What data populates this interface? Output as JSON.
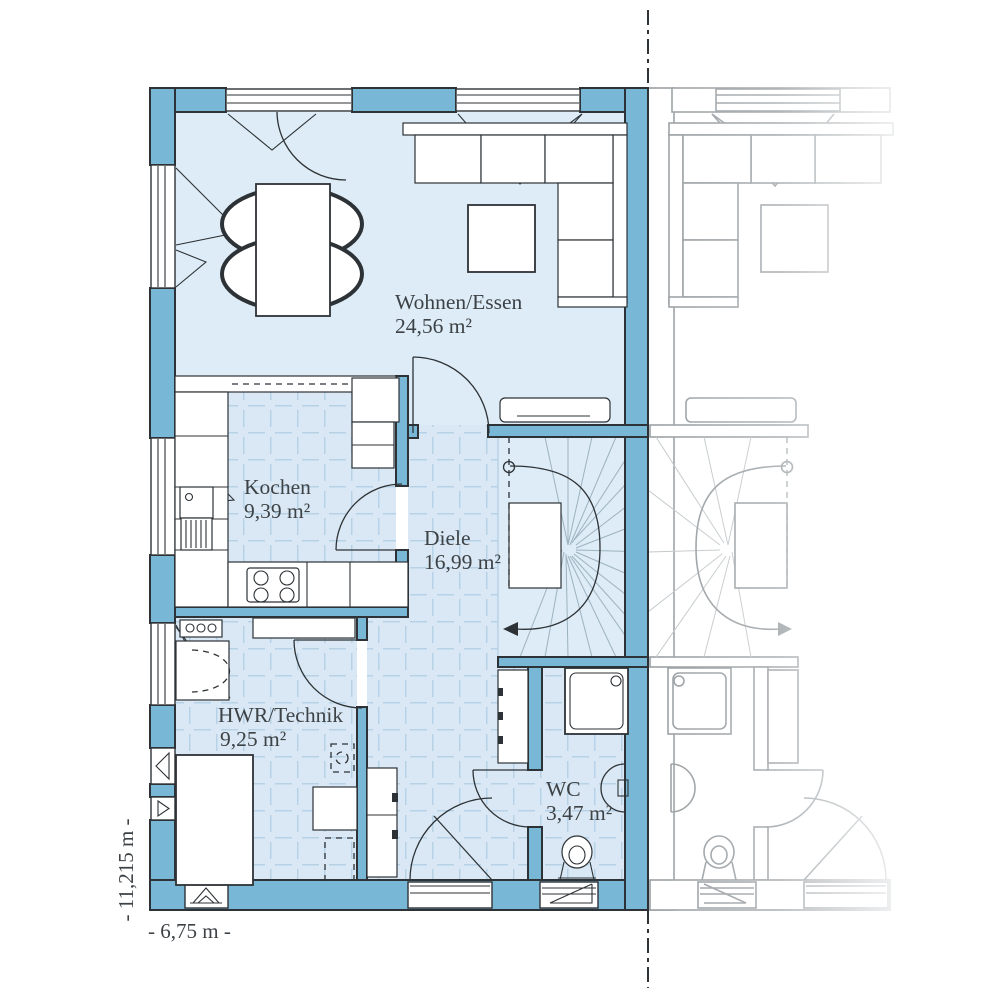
{
  "plan": {
    "title": "floor-plan-ground-floor",
    "rooms": [
      {
        "id": "wohnen",
        "label": "Wohnen/Essen",
        "area": "24,56 m²"
      },
      {
        "id": "kochen",
        "label": "Kochen",
        "area": "9,39 m²"
      },
      {
        "id": "diele",
        "label": "Diele",
        "area": "16,99 m²"
      },
      {
        "id": "hwr",
        "label": "HWR/Technik",
        "area": "9,25 m²"
      },
      {
        "id": "wc",
        "label": "WC",
        "area": "3,47 m²"
      }
    ],
    "dimensions": {
      "height_label": "- 11,215 m -",
      "width_label": "- 6,75 m -"
    },
    "colors": {
      "wall_fill": "#79b7d7",
      "floor_light": "#ddecf6",
      "tile_floor": "#d9e8f4",
      "tile_line": "#b7d2e6",
      "outline": "#2d3236",
      "label_text": "#3d4246",
      "ghost_line": "#9aa0a4"
    }
  }
}
